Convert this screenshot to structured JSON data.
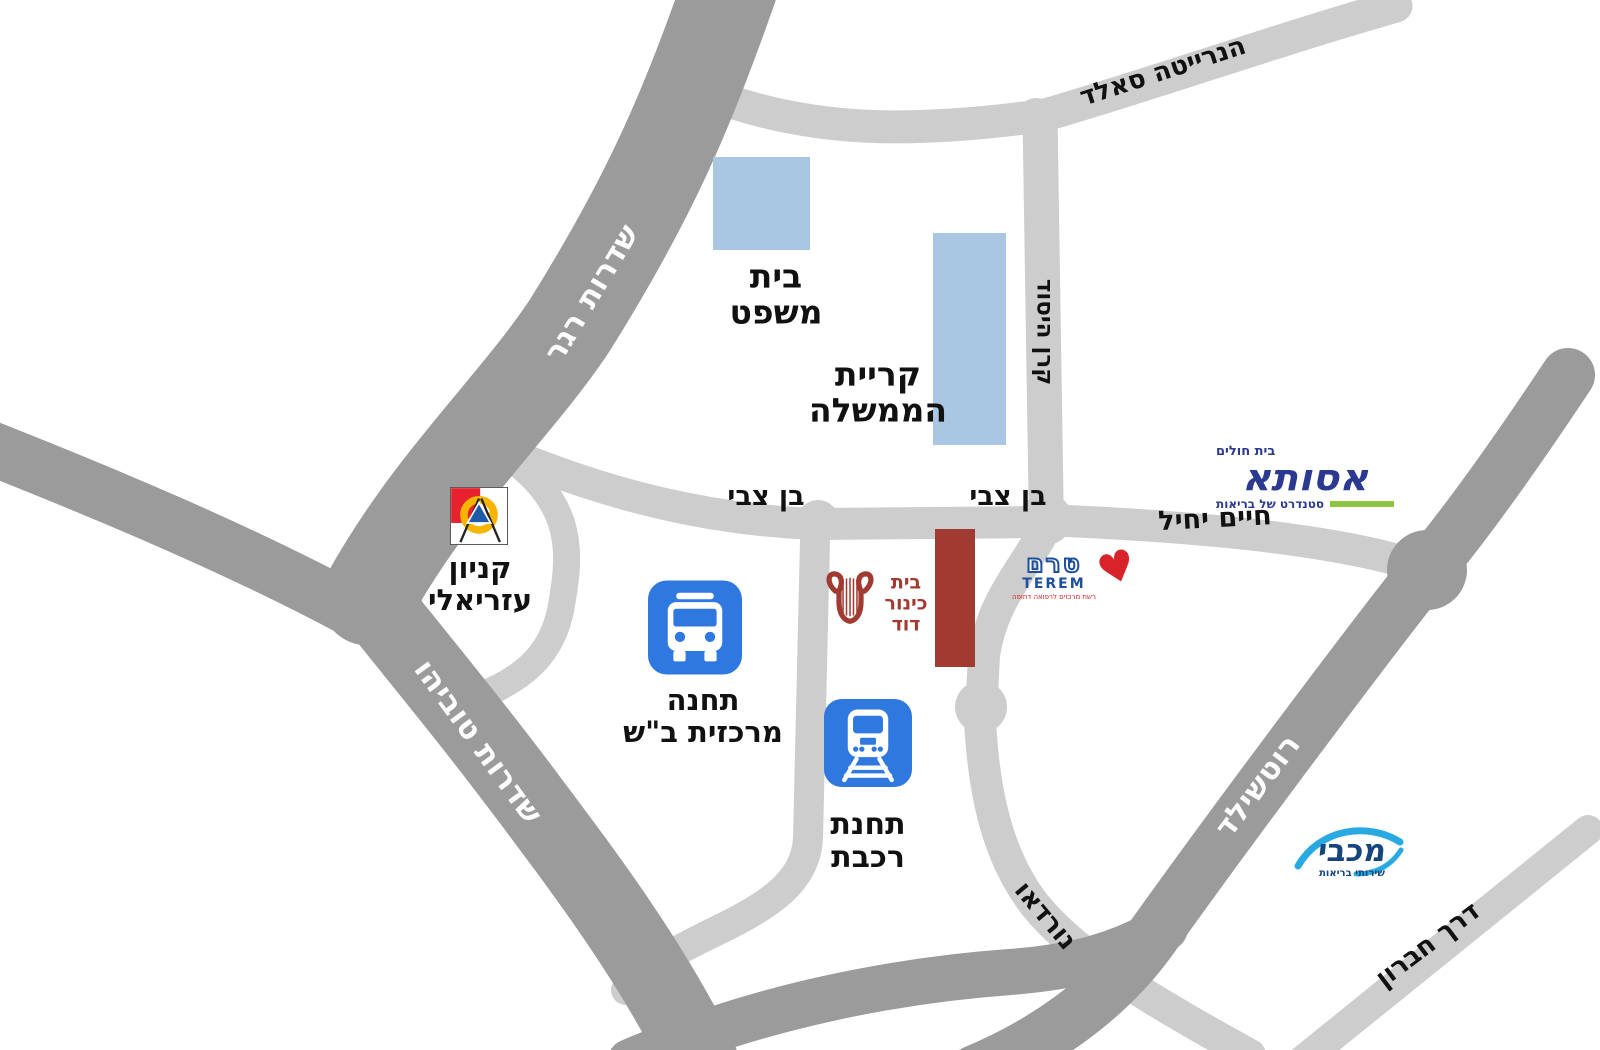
{
  "roads": {
    "rager": "שדרות רגר",
    "tuviyahu": "שדרות טוביהו",
    "rothschild": "רוטשילד",
    "henrietta_szold": "הנרייטה סאלד",
    "keren_hayesod": "קרן היסוד",
    "ben_zvi": "בן צבי",
    "haim_yahil": "חיים יחיל",
    "nordau": "נורדאו",
    "derech_hevron": "דרך חברון"
  },
  "places": {
    "courthouse": "בית\nמשפט",
    "government_complex": "קריית\nהממשלה",
    "azrieli_mall": "קניון\nעזריאלי",
    "central_bus_station": "תחנה\nמרכזית ב\"ש",
    "train_station": "תחנת\nרכבת",
    "kinor_david": "בית\nכינור\nדוד"
  },
  "logos": {
    "assuta": {
      "hospital_label": "בית חולים",
      "name": "אסותא",
      "tagline": "סטנדרט של בריאות"
    },
    "terem": {
      "name_hebrew": "טרם",
      "name_latin": "TEREM",
      "tagline": "רשת מרכזים לרפואה דחופה"
    },
    "maccabi": {
      "name": "מכבי",
      "tagline": "שירותי בריאות"
    }
  },
  "colors": {
    "road_major": "#9b9b9b",
    "road_minor": "#cdcdcd",
    "building_blue": "#a9c6e3",
    "building_red": "#a13a31",
    "icon_blue": "#2e78e0",
    "label_black": "#111111",
    "road_text_white": "#ffffff",
    "assuta_navy": "#2b3990",
    "assuta_green": "#8cc63f",
    "terem_blue": "#1d4f9e",
    "terem_red": "#d8232a",
    "maccabi_navy": "#15457c",
    "maccabi_light_blue": "#29a9e1"
  }
}
